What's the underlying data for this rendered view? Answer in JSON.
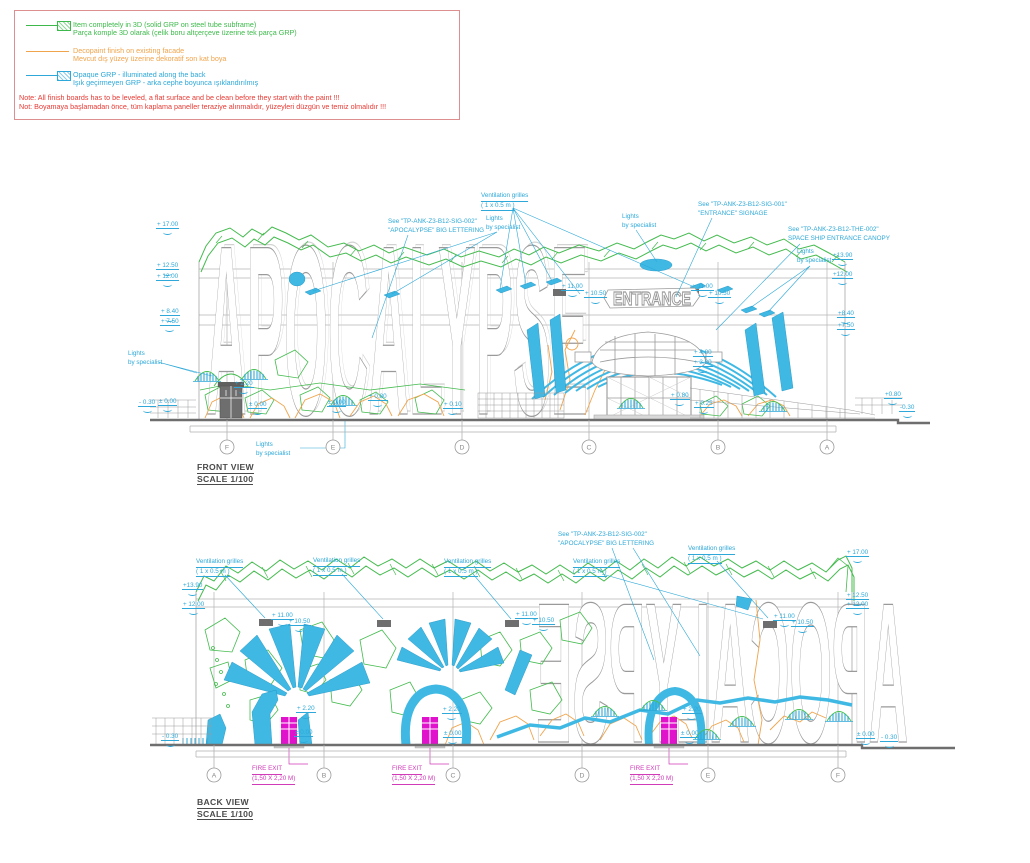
{
  "palette": {
    "green": "#3cb94a",
    "orange": "#f0a44c",
    "cyan": "#2da8d8",
    "cyan_fill": "#3fb9e4",
    "magenta": "#e012cc",
    "note_red": "#e63a34",
    "line_gray": "#9a9a9a"
  },
  "legend": {
    "items": [
      {
        "line1": "Item completely in 3D  (solid GRP on steel tube subframe)",
        "line2": "Parça komple 3D olarak (çelik boru altçerçeve üzerine tek parça GRP)",
        "color": "#3cb94a",
        "swatch": "hatched"
      },
      {
        "line1": "Decopaint finish on existing facade",
        "line2": "Mevcut dış yüzey üzerine dekoratif son kat boya",
        "color": "#f0a44c",
        "swatch": "none"
      },
      {
        "line1": "Opaque GRP - illuminated along the back",
        "line2": "Işık geçirmeyen GRP - arka cephe boyunca ışıklandırılmış",
        "color": "#2da8d8",
        "swatch": "hatched"
      }
    ],
    "note": {
      "line1": "Note: All finish boards has to be leveled, a flat surface and be clean before they start with the paint !!!",
      "line2": "Not: Boyamaya başlamadan önce, tüm kaplama paneller teraziye alınmalıdır, yüzeyleri düzgün ve temiz olmalıdır !!!"
    }
  },
  "front_view": {
    "title": "FRONT VIEW",
    "scale_label": "SCALE 1/100",
    "big_lettering": "APOCALYPSE",
    "entrance_sign": "ENTRANCE",
    "grid_labels": [
      "F",
      "E",
      "D",
      "C",
      "B",
      "A"
    ],
    "callouts": [
      {
        "line1": "Ventilation grilles",
        "line2": "( 1 x 0.5 m )"
      },
      {
        "line1": "Lights",
        "line2": "by specialist"
      },
      {
        "line1": "Lights",
        "line2": "by specialist"
      },
      {
        "line1": "See \"TP-ANK-Z3-B12-SIG-001\"",
        "line2": "\"ENTRANCE\" SIGNAGE"
      },
      {
        "line1": "See \"TP-ANK-Z3-B12-SIG-002\"",
        "line2": "\"APOCALYPSE\" BIG LETTERING"
      },
      {
        "line1": "See \"TP-ANK-Z3-B12-THE-002\"",
        "line2": "SPACE SHIP ENTRANCE CANOPY"
      },
      {
        "line1": "Lights",
        "line2": "by specialist"
      },
      {
        "line1": "Lights",
        "line2": "by specialist"
      },
      {
        "line1": "Lights",
        "line2": "by specialist"
      }
    ],
    "levels": [
      "+ 17.00",
      "+ 12.50",
      "+ 12.00",
      "+ 8.40",
      "+ 7.50",
      "- 0.30",
      "± 0.00",
      "+ 2.20",
      "± 0.00",
      "± 0.00",
      "+ 0.80",
      "+ 0.10",
      "+ 11.00",
      "+ 10.50",
      "+ 11.00",
      "+ 10.50",
      "+ 4.80",
      "+ 3.80",
      "+ 0.80",
      "+ 0.25",
      "+13.90",
      "+12.00",
      "+8.40",
      "+7.50",
      "+0.80",
      "-0.30"
    ]
  },
  "back_view": {
    "title": "BACK VIEW",
    "scale_label": "SCALE 1/100",
    "big_lettering": "APOCALYPSE",
    "grid_labels": [
      "A",
      "B",
      "C",
      "D",
      "E",
      "F"
    ],
    "callouts": [
      {
        "line1": "Ventilation grilles",
        "line2": "( 1 x 0.5 m )"
      },
      {
        "line1": "Ventilation grilles",
        "line2": "( 1 x 0.5 m )"
      },
      {
        "line1": "Ventilation grilles",
        "line2": "( 1 x 0.5 m )"
      },
      {
        "line1": "Ventilation grilles",
        "line2": "( 1 x 0.5 m )"
      },
      {
        "line1": "Ventilation grilles",
        "line2": "( 1 x 0.5 m )"
      },
      {
        "line1": "See \"TP-ANK-Z3-B12-SIG-002\"",
        "line2": "\"APOCALYPSE\" BIG LETTERING"
      }
    ],
    "levels": [
      "+13.90",
      "+ 12.00",
      "+ 11.00",
      "+ 10.50",
      "+ 11.00",
      "+ 10.50",
      "+ 11.00",
      "+ 10.50",
      "+ 17.00",
      "+ 12.50",
      "+ 12.00",
      "+ 2.20",
      "± 0.00",
      "+ 2.20",
      "± 0.00",
      "+ 2.20",
      "± 0.00",
      "± 0.00",
      "- 0.30",
      "- 0.30"
    ],
    "fire_exits": [
      {
        "line1": "FIRE EXIT",
        "line2": "(1,50 X 2,20 M)"
      },
      {
        "line1": "FIRE EXIT",
        "line2": "(1,50 X 2,20 M)"
      },
      {
        "line1": "FIRE EXIT",
        "line2": "(1,50 X 2,20 M)"
      }
    ]
  }
}
